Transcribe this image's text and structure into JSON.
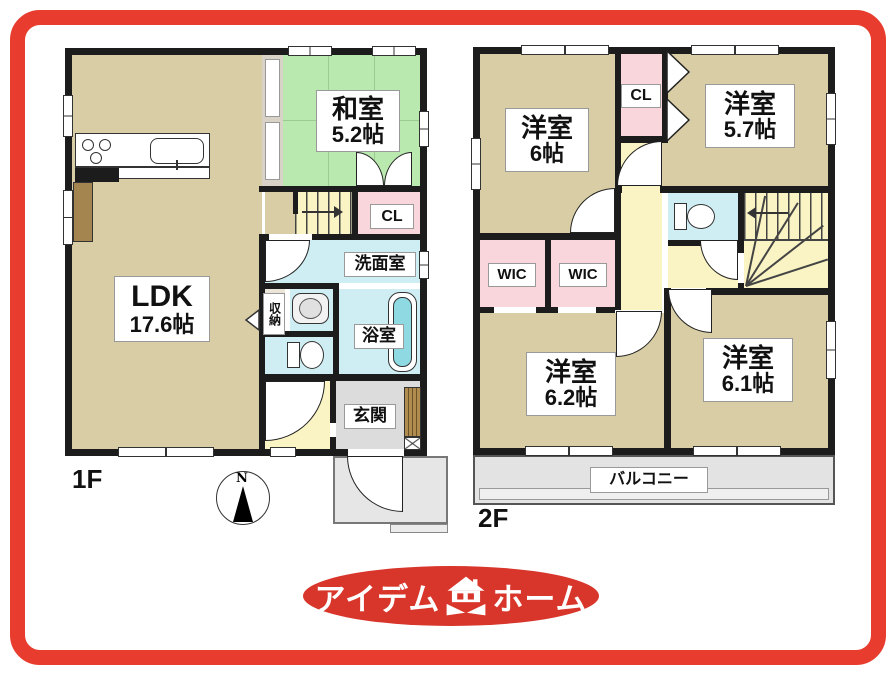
{
  "palette": {
    "frame_red": "#e73c2e",
    "logo_red": "#d8352b",
    "wall_black": "#1c1c1c",
    "floor_tan": "#d8cda4",
    "tatami_green": "#b9e9ae",
    "closet_pink": "#f9d6dc",
    "wet_cyan": "#cfeef4",
    "hall_yellow": "#faf4c4",
    "entry_gray": "#dcdcdc",
    "balcony_gray": "#e3e3e3",
    "wood_brown": "#a5854f"
  },
  "floor1": {
    "floor_label": "1F",
    "ldk": {
      "name": "LDK",
      "size": "17.6帖"
    },
    "washitsu": {
      "name": "和室",
      "size": "5.2帖"
    },
    "closet": "CL",
    "washroom": "洗面室",
    "storage": "収納",
    "bathroom": "浴室",
    "entrance": "玄関"
  },
  "floor2": {
    "floor_label": "2F",
    "bedroom_6": {
      "name": "洋室",
      "size": "6帖"
    },
    "closet": "CL",
    "bedroom_57": {
      "name": "洋室",
      "size": "5.7帖"
    },
    "wic_left": "WIC",
    "wic_right": "WIC",
    "bedroom_62": {
      "name": "洋室",
      "size": "6.2帖"
    },
    "bedroom_61": {
      "name": "洋室",
      "size": "6.1帖"
    },
    "balcony": "バルコニー"
  },
  "compass": {
    "north": "N"
  },
  "logo": {
    "left": "アイデム",
    "right": "ホーム"
  }
}
